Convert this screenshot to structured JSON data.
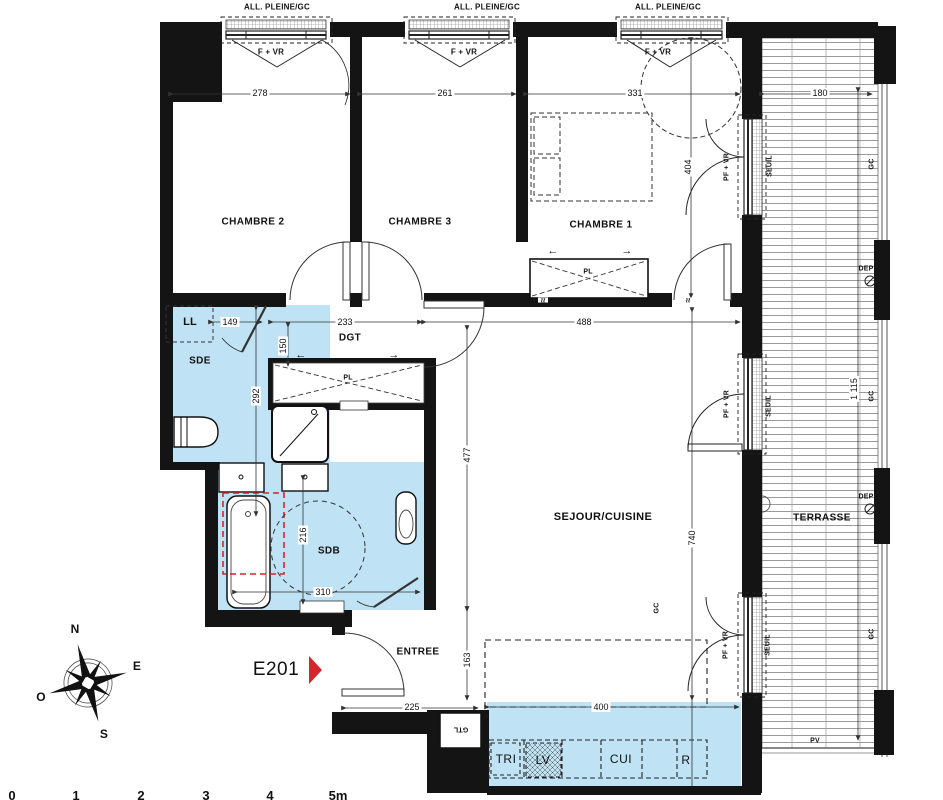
{
  "unit": {
    "id": "E201"
  },
  "rooms": {
    "chambre2": "CHAMBRE 2",
    "chambre3": "CHAMBRE 3",
    "chambre1": "CHAMBRE 1",
    "sde": "SDE",
    "sdb": "SDB",
    "dgt": "DGT",
    "sejour": "SEJOUR/CUISINE",
    "terrasse": "TERRASSE",
    "entree": "ENTREE"
  },
  "openings": {
    "all_pleine": "ALL. PLEINE/GC",
    "f_vr": "F + VR",
    "pf_vr": "PF + VR",
    "seuil": "SEUIL"
  },
  "annotations": {
    "gc": "GC",
    "dep": "DEP",
    "pv": "PV",
    "gtl": "GTL",
    "pl": "PL",
    "ll": "LL"
  },
  "kitchen": {
    "tri": "TRI",
    "lv": "LV",
    "cui": "CUI",
    "r": "R"
  },
  "dims": {
    "w_ch2": "278",
    "w_ch3": "261",
    "w_ch1": "331",
    "w_terr": "180",
    "ll_w": "149",
    "dgt_w": "233",
    "sej_w": "488",
    "dgt_h": "150",
    "sde_h": "292",
    "sdb_h": "216",
    "sdb_w": "310",
    "ch1_h": "404",
    "sej_h1": "477",
    "sej_h2": "163",
    "sej_h3": "740",
    "terr_h": "1 115",
    "ent_w": "225",
    "kit_w": "400"
  },
  "compass": {
    "n": "N",
    "e": "E",
    "s": "S",
    "o": "O"
  },
  "scale_ticks": [
    "0",
    "1",
    "2",
    "3",
    "4",
    "5m"
  ],
  "symbols": {
    "arrow_left": "←",
    "arrow_right": "→",
    "approx": "≈"
  },
  "colors": {
    "room_fill": "#bfe3f4",
    "accent_red": "#d4252e",
    "wall": "#141414"
  }
}
